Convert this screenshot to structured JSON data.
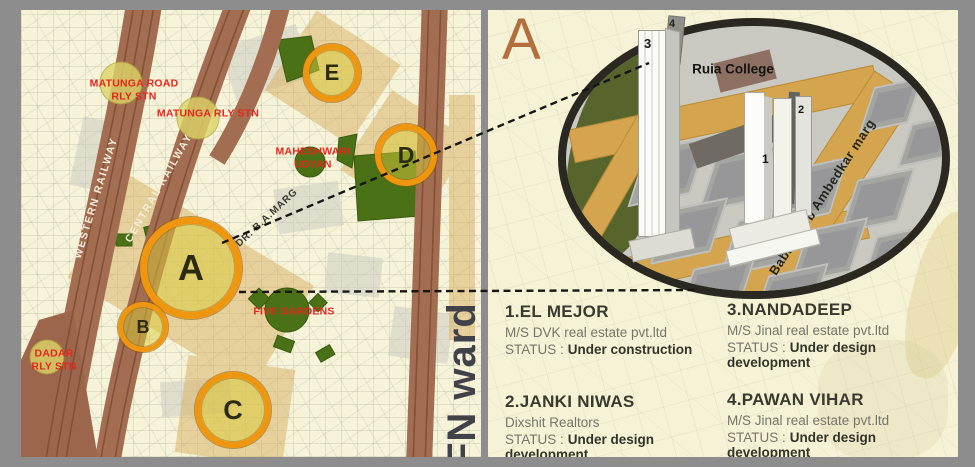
{
  "left_map": {
    "ward_label": "FN ward",
    "railway_labels": {
      "western": "WESTERN RAILWAY",
      "central": "CENTRAL RAILWAY"
    },
    "stations": {
      "matunga_road": "MATUNGA ROAD\nRLY STN",
      "matunga": "MATUNGA RLY STN",
      "dadar": "DADAR\nRLY STN"
    },
    "landmarks": {
      "maheshwari_udyan": "MAHESHWARI\nUDYAN",
      "five_gardens": "FIVE GARDENS",
      "road": "DR. B.A.MARG"
    },
    "markers": {
      "a": "A",
      "b": "B",
      "c": "C",
      "d": "D",
      "e": "E"
    }
  },
  "detail_panel": {
    "section_letter": "A",
    "inset": {
      "college": "Ruia College",
      "road": "Babasaheb Ambedkar marg",
      "towers": {
        "t1": "1",
        "t2": "2",
        "t3": "3",
        "t4": "4"
      }
    },
    "projects": [
      {
        "title": "1.EL MEJOR",
        "developer": "M/S DVK real estate pvt.ltd",
        "status_label": "STATUS :",
        "status": "Under construction"
      },
      {
        "title": "2.JANKI NIWAS",
        "developer": "Dixshit Realtors",
        "status_label": "STATUS :",
        "status": "Under design development"
      },
      {
        "title": "3.NANDADEEP",
        "developer": "M/S Jinal real estate pvt.ltd",
        "status_label": "STATUS :",
        "status": "Under design development"
      },
      {
        "title": "4.PAWAN VIHAR",
        "developer": "M/S Jinal real estate pvt.ltd",
        "status_label": "STATUS :",
        "status": "Under design development"
      }
    ],
    "colors": {
      "marker_ring": "#ef9611",
      "station_label_red": "#e6251d",
      "railway_brown": "#a26d51",
      "road_tan": "#d5a44f",
      "frame_gray": "#8d8d8d"
    }
  }
}
